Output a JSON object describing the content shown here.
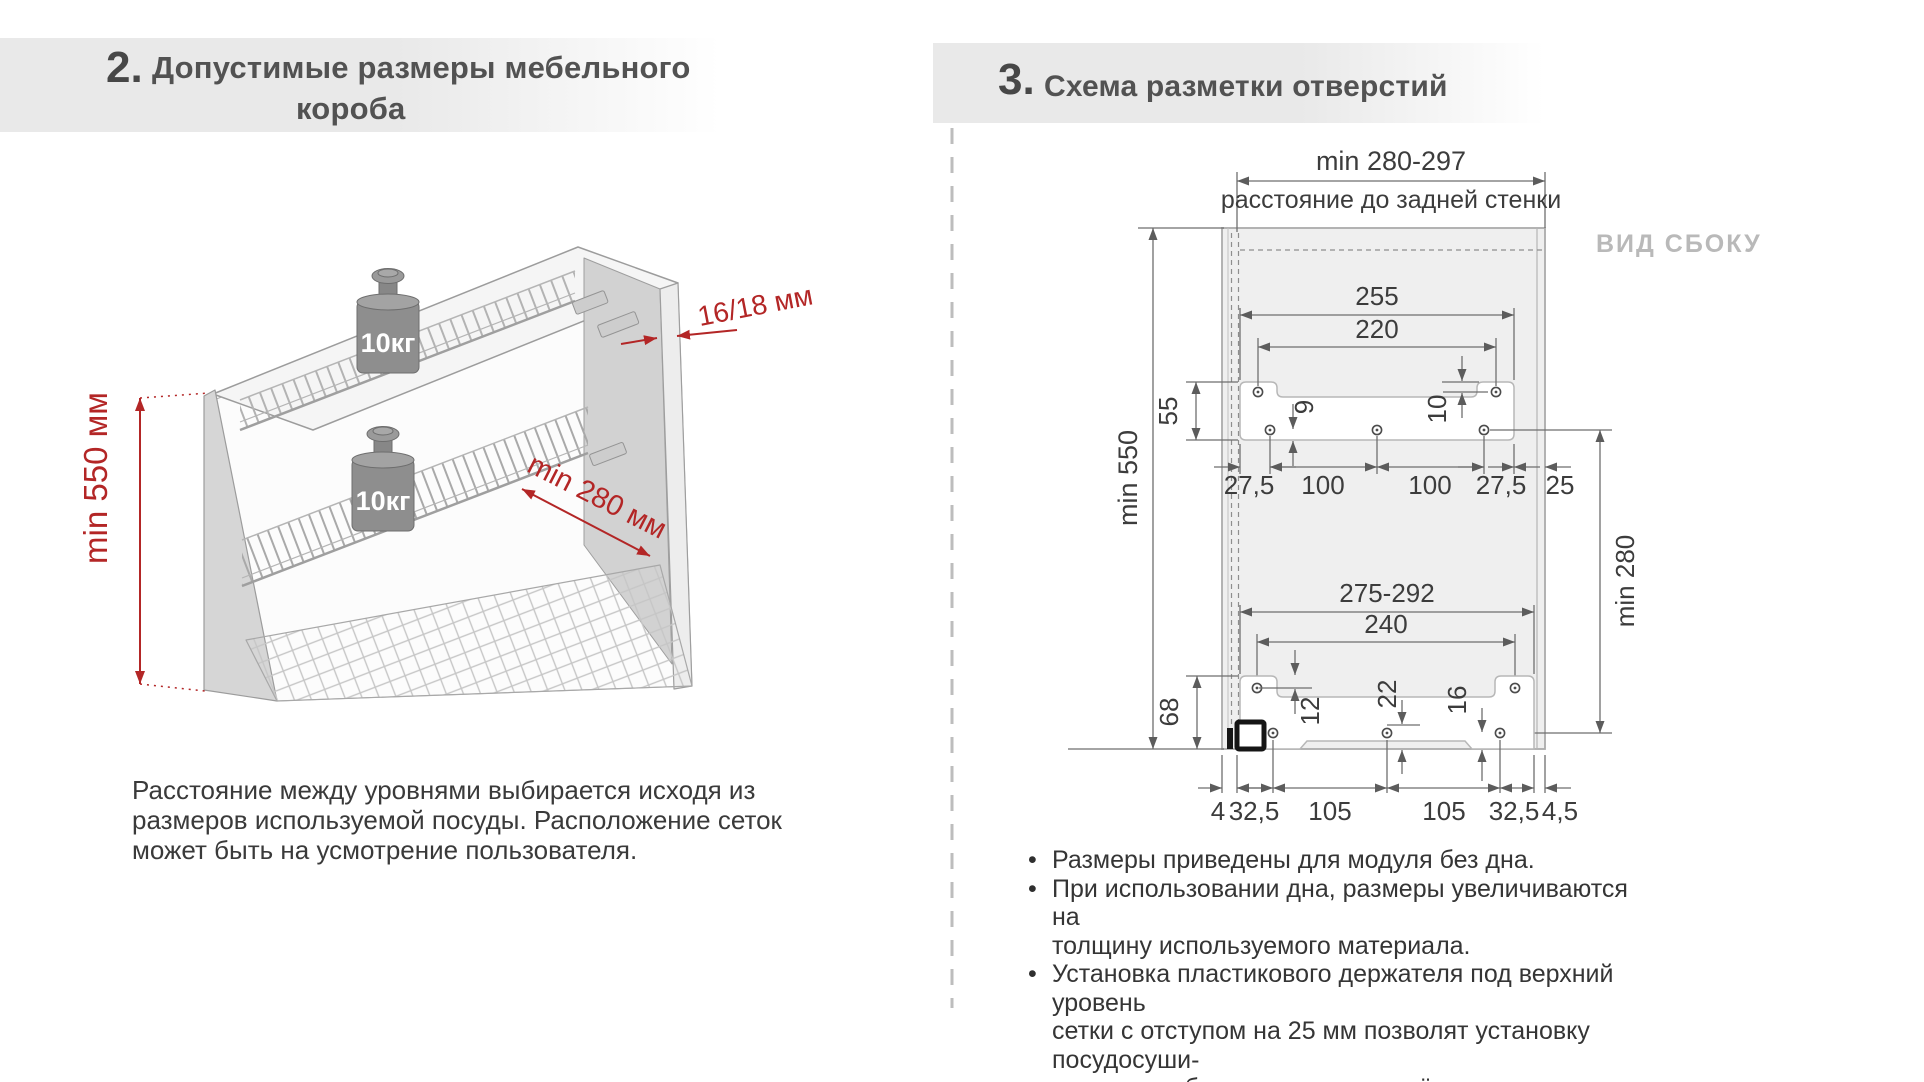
{
  "headers": {
    "left": {
      "number": "2.",
      "line1": "Допустимые размеры  мебельного",
      "line2": "короба"
    },
    "right": {
      "number": "3.",
      "title": "Схема разметки отверстий"
    }
  },
  "cabinet": {
    "height_label": "min 550 мм",
    "thickness_label": "16/18 мм",
    "depth_label": "min 280 мм",
    "weight_upper": "10кг",
    "weight_lower": "10кг",
    "note": [
      "Расстояние между уровнями выбирается исходя из",
      "размеров используемой посуды. Расположение сеток",
      "может быть на усмотрение пользователя."
    ]
  },
  "holes": {
    "view_label": "ВИД СБОКУ",
    "back_dim": "min 280-297",
    "back_caption": "расстояние до задней стенки",
    "min_height": "min 550",
    "min_levels": "min 280",
    "marker": "•",
    "upper": {
      "width": "255",
      "holes_span": "220",
      "height": "55",
      "top_offset": "10",
      "bottom_offset": "9",
      "row": [
        "27,5",
        "100",
        "100",
        "27,5",
        "25"
      ]
    },
    "lower": {
      "width": "275-292",
      "holes_span": "240",
      "height": "68",
      "top_offset": "12",
      "mid_offset": "22",
      "right_offset": "16",
      "row": [
        "4",
        "32,5",
        "105",
        "105",
        "32,5",
        "4,5"
      ]
    },
    "bullets": [
      {
        "lines": [
          "Размеры приведены для модуля без дна."
        ]
      },
      {
        "lines": [
          "При использовании дна, размеры увеличиваются на",
          "толщину используемого материала."
        ]
      },
      {
        "lines": [
          "Установка пластикового держателя под верхний уровень",
          "сетки с отступом на 25 мм позволят установку посудосуши-",
          "теля в короб со складным подъёмным механизмом."
        ]
      }
    ]
  },
  "colors": {
    "accent_red": "#b32626",
    "dim_line": "#6e6e6e",
    "panel_fill": "#efefef",
    "band": "#e9e9e9"
  }
}
